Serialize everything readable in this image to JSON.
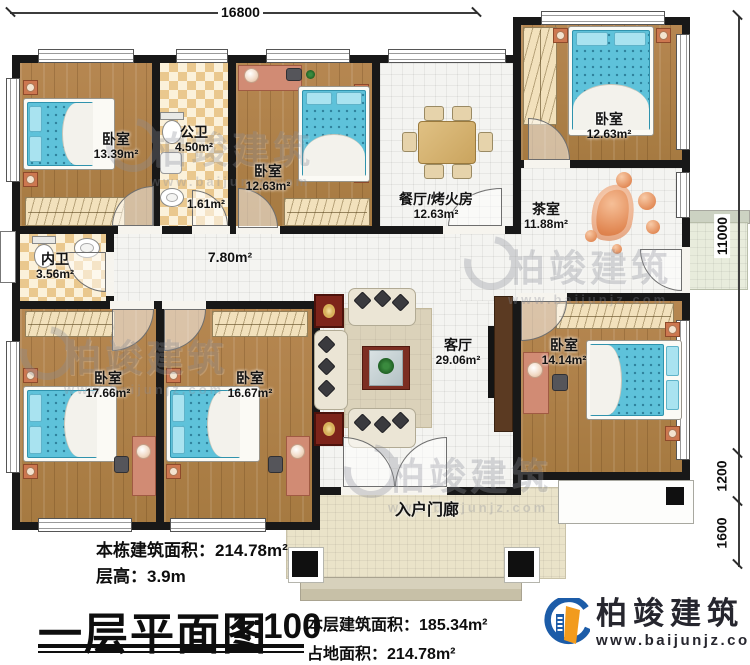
{
  "title_block": {
    "title": "一层平面图",
    "scale": "1:100"
  },
  "dimensions": {
    "top_width": "16800",
    "right_total": "11000",
    "right_upper": "1200",
    "right_lower": "1600"
  },
  "rooms": {
    "bedroom_tl": {
      "name": "卧室",
      "area": "13.39m²"
    },
    "bath_public": {
      "name": "公卫",
      "area": "4.50m²",
      "sub_area": "1.61m²"
    },
    "bedroom_tm": {
      "name": "卧室",
      "area": "12.63m²"
    },
    "dining": {
      "name": "餐厅/烤火房",
      "area": "12.63m²"
    },
    "bedroom_tr": {
      "name": "卧室",
      "area": "12.63m²"
    },
    "tea": {
      "name": "茶室",
      "area": "11.88m²"
    },
    "bath_inner": {
      "name": "内卫",
      "area": "3.56m²"
    },
    "hallway": {
      "area": "7.80m²"
    },
    "bedroom_bl": {
      "name": "卧室",
      "area": "17.66m²"
    },
    "bedroom_bm": {
      "name": "卧室",
      "area": "16.67m²"
    },
    "living": {
      "name": "客厅",
      "area": "29.06m²"
    },
    "bedroom_br": {
      "name": "卧室",
      "area": "14.14m²"
    },
    "porch": {
      "name": "入户门廊"
    }
  },
  "info": {
    "building_area_label": "本栋建筑面积：",
    "building_area_value": "214.78m²",
    "floor_height_label": "层高：",
    "floor_height_value": "3.9m",
    "floor_area_label": "本层建筑面积：",
    "floor_area_value": "185.34m²",
    "ground_area_label": "占地面积：",
    "ground_area_value": "214.78m²"
  },
  "branding": {
    "logo_text": "柏竣建筑",
    "website": "www.baijunjz.com"
  },
  "watermark": {
    "text": "柏竣建筑",
    "url": "www.baijunjz.com"
  }
}
